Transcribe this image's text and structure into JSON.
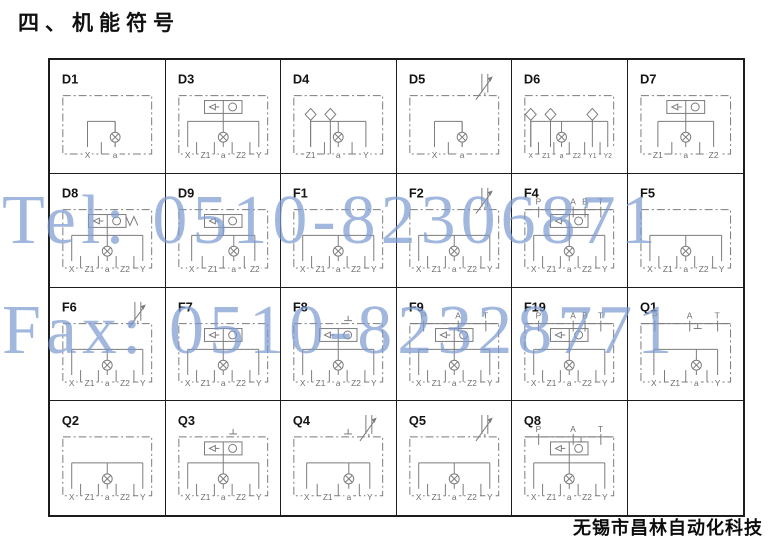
{
  "title": "四、机能符号",
  "watermark": {
    "line1": "Tel: 0510-82306871",
    "line2": "Fax: 0510-82328771",
    "color": "#7e9cd2"
  },
  "footer": {
    "company": "无锡市昌林自动化科技"
  },
  "colors": {
    "schematic_line": "#7b7b7b",
    "table_border": "#1c1c1c",
    "label_text": "#141414",
    "port_text": "#6e6e6e"
  },
  "grid": {
    "columns": 6,
    "rows": 4
  },
  "cells": [
    {
      "label": "D1",
      "top_ports": [],
      "bottom_ports": [
        "X",
        "a"
      ],
      "valve": 0,
      "checks": 0,
      "throttle": false,
      "tee": false
    },
    {
      "label": "D3",
      "top_ports": [],
      "bottom_ports": [
        "X",
        "Z1",
        "a",
        "Z2",
        "Y"
      ],
      "valve": 1,
      "checks": 0,
      "throttle": false,
      "tee": false
    },
    {
      "label": "D4",
      "top_ports": [],
      "bottom_ports": [
        "Z1",
        "a",
        "Y"
      ],
      "valve": 0,
      "checks": 2,
      "throttle": false,
      "tee": false
    },
    {
      "label": "D5",
      "top_ports": [],
      "bottom_ports": [
        "X",
        "a"
      ],
      "valve": 0,
      "checks": 0,
      "throttle": true,
      "tee": false
    },
    {
      "label": "D6",
      "top_ports": [],
      "bottom_ports": [
        "X",
        "Z1",
        "a",
        "Z2",
        "Y1",
        "Y2"
      ],
      "valve": 0,
      "checks": 3,
      "throttle": false,
      "tee": false
    },
    {
      "label": "D7",
      "top_ports": [],
      "bottom_ports": [
        "Z1",
        "a",
        "Z2"
      ],
      "valve": 1,
      "checks": 0,
      "throttle": false,
      "tee": false
    },
    {
      "label": "D8",
      "top_ports": [],
      "bottom_ports": [
        "X",
        "Z1",
        "a",
        "Z2",
        "Y"
      ],
      "valve": 2,
      "checks": 0,
      "throttle": false,
      "tee": false
    },
    {
      "label": "D9",
      "top_ports": [],
      "bottom_ports": [
        "X",
        "Z1",
        "a",
        "Z2"
      ],
      "valve": 1,
      "checks": 0,
      "throttle": false,
      "tee": false
    },
    {
      "label": "F1",
      "top_ports": [],
      "bottom_ports": [
        "X",
        "Z1",
        "a",
        "Z2",
        "Y"
      ],
      "valve": 0,
      "checks": 0,
      "throttle": false,
      "tee": false
    },
    {
      "label": "F2",
      "top_ports": [],
      "bottom_ports": [
        "X",
        "Z1",
        "a",
        "Z2",
        "Y"
      ],
      "valve": 0,
      "checks": 0,
      "throttle": true,
      "tee": false
    },
    {
      "label": "F4",
      "top_ports": [
        "P",
        "A",
        "B",
        "T"
      ],
      "bottom_ports": [
        "X",
        "Z1",
        "a",
        "Z2",
        "Y"
      ],
      "valve": 1,
      "checks": 0,
      "throttle": false,
      "tee": true
    },
    {
      "label": "F5",
      "top_ports": [],
      "bottom_ports": [
        "X",
        "Z1",
        "a",
        "Z2",
        "Y"
      ],
      "valve": 0,
      "checks": 0,
      "throttle": false,
      "tee": false
    },
    {
      "label": "F6",
      "top_ports": [],
      "bottom_ports": [
        "X",
        "Z1",
        "a",
        "Z2",
        "Y"
      ],
      "valve": 0,
      "checks": 0,
      "throttle": true,
      "tee": false
    },
    {
      "label": "F7",
      "top_ports": [],
      "bottom_ports": [
        "X",
        "Z1",
        "a",
        "Z2",
        "Y"
      ],
      "valve": 1,
      "checks": 0,
      "throttle": false,
      "tee": false
    },
    {
      "label": "F8",
      "top_ports": [],
      "bottom_ports": [
        "X",
        "Z1",
        "a",
        "Z2",
        "Y"
      ],
      "valve": 1,
      "checks": 0,
      "throttle": false,
      "tee": true
    },
    {
      "label": "F9",
      "top_ports": [
        "P",
        "A",
        "T"
      ],
      "bottom_ports": [
        "X",
        "Z1",
        "a",
        "Z2",
        "Y"
      ],
      "valve": 1,
      "checks": 0,
      "throttle": false,
      "tee": false
    },
    {
      "label": "F19",
      "top_ports": [
        "P",
        "A",
        "B",
        "T"
      ],
      "bottom_ports": [
        "X",
        "Z1",
        "a",
        "Z2",
        "Y"
      ],
      "valve": 1,
      "checks": 0,
      "throttle": false,
      "tee": false
    },
    {
      "label": "Q1",
      "top_ports": [
        "P",
        "A",
        "T"
      ],
      "bottom_ports": [
        "X",
        "Z1",
        "a",
        "Y"
      ],
      "valve": 0,
      "checks": 0,
      "throttle": false,
      "tee": true
    },
    {
      "label": "Q2",
      "top_ports": [],
      "bottom_ports": [
        "X",
        "Z1",
        "a",
        "Z2",
        "Y"
      ],
      "valve": 0,
      "checks": 0,
      "throttle": false,
      "tee": false
    },
    {
      "label": "Q3",
      "top_ports": [],
      "bottom_ports": [
        "X",
        "Z1",
        "a",
        "Z2",
        "Y"
      ],
      "valve": 1,
      "checks": 0,
      "throttle": false,
      "tee": true
    },
    {
      "label": "Q4",
      "top_ports": [],
      "bottom_ports": [
        "X",
        "Z1",
        "a",
        "Y"
      ],
      "valve": 0,
      "checks": 0,
      "throttle": true,
      "tee": true
    },
    {
      "label": "Q5",
      "top_ports": [],
      "bottom_ports": [
        "X",
        "Z1",
        "a",
        "Z2",
        "Y"
      ],
      "valve": 0,
      "checks": 0,
      "throttle": true,
      "tee": false
    },
    {
      "label": "Q8",
      "top_ports": [
        "P",
        "A",
        "T"
      ],
      "bottom_ports": [
        "X",
        "Z1",
        "a",
        "Z2",
        "Y"
      ],
      "valve": 1,
      "checks": 0,
      "throttle": false,
      "tee": true
    },
    {
      "label": "",
      "top_ports": [],
      "bottom_ports": [],
      "valve": 0,
      "checks": 0,
      "throttle": false,
      "tee": false
    }
  ]
}
